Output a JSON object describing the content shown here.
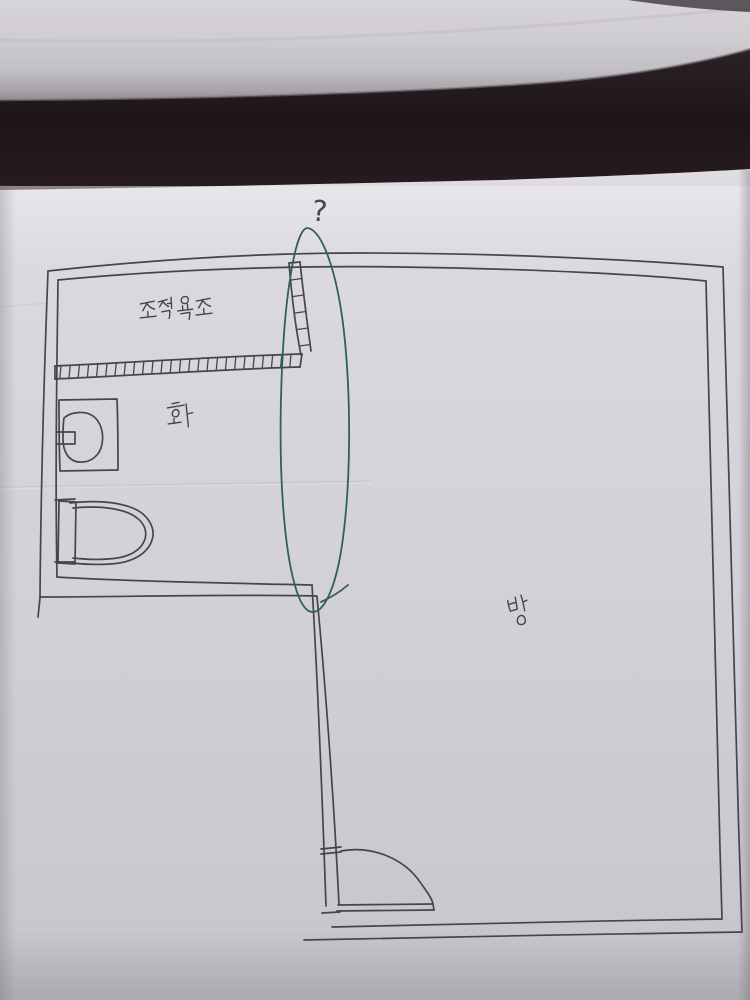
{
  "photo": {
    "description": "Hand-drawn pen floor plan sketch on paper, photographed with dark shadow band and rolled paper at top",
    "labels": {
      "bathtub": "조적욕조",
      "bathroom": "화",
      "room": "방",
      "question_mark": "?"
    },
    "colors": {
      "pen": "#46454d",
      "green_pen": "#2e6157",
      "paper": "#d4d2d8",
      "paper_bright": "#dedce1",
      "paper_roll": "#cdcad0",
      "dark_band": "#221920"
    }
  }
}
